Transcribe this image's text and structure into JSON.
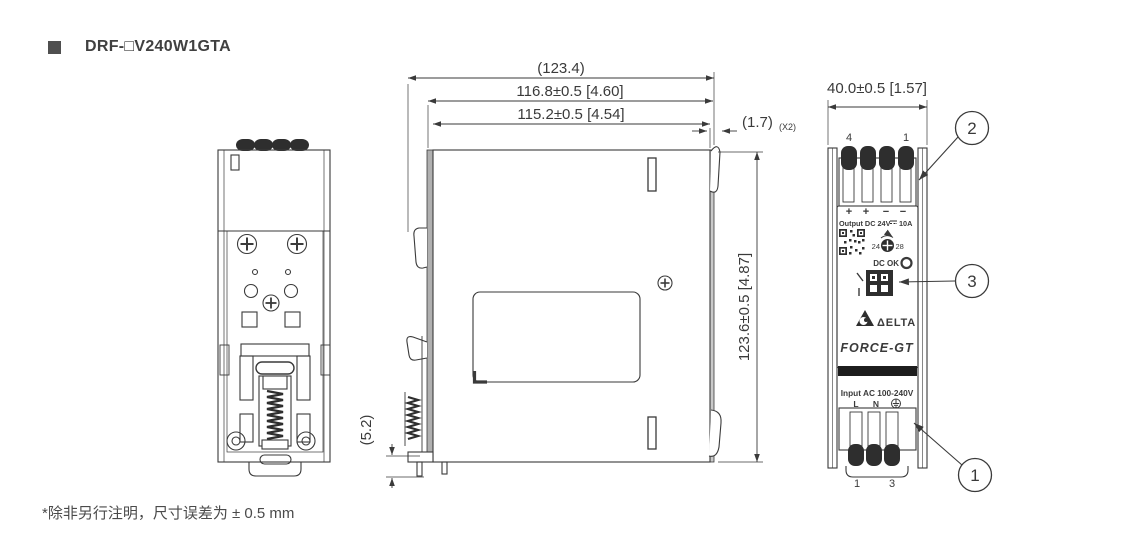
{
  "title": {
    "text": "DRF-□V240W1GTA"
  },
  "footnote": "*除非另行注明，尺寸误差为 ± 0.5 mm",
  "dims": {
    "overall_width": "(123.4)",
    "body_width": "116.8±0.5  [4.60]",
    "inner_width": "115.2±0.5  [4.54]",
    "tab_width": "(1.7)",
    "tab_qty": "(X2)",
    "front_width": "40.0±0.5  [1.57]",
    "height": "123.6±0.5  [4.87]",
    "clip_offset": "(5.2)"
  },
  "callouts": {
    "input_terminal": "1",
    "output_terminal": "2",
    "dip_switch": "3"
  },
  "front": {
    "top_pin_left": "4",
    "top_pin_right": "1",
    "polarity": [
      "+",
      "+",
      "−",
      "−"
    ],
    "output_label": "Output DC 24V",
    "output_current": "10A",
    "adjust_min": "24",
    "adjust_max": "28",
    "dc_ok": "DC OK",
    "brand": "ΔELTA",
    "series": "FORCE-GT",
    "input_label": "Input AC 100-240V",
    "line": "L",
    "neutral": "N",
    "bottom_pin_left": "1",
    "bottom_pin_right": "3"
  },
  "colors": {
    "line": "#3a3a3a",
    "dark_fill": "#2e2e2e"
  }
}
